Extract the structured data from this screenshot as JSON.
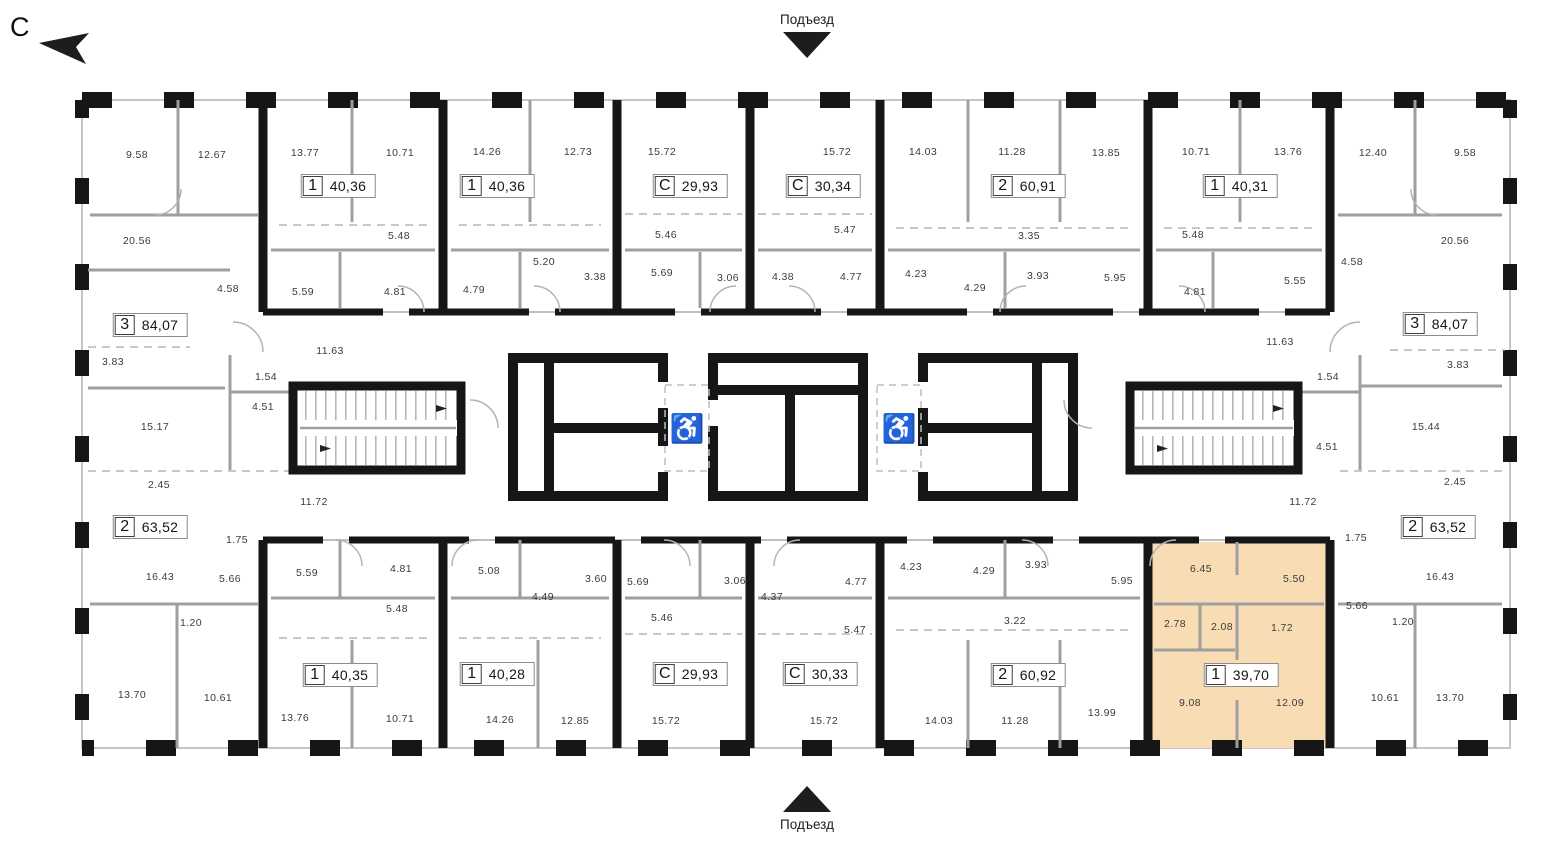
{
  "compass": {
    "label": "С"
  },
  "entrances": {
    "top_label": "Подъезд",
    "bottom_label": "Подъезд"
  },
  "icons": {
    "wheelchair": "♿",
    "compass_arrow": "compass-arrow",
    "entrance_arrow": "triangle"
  },
  "colors": {
    "highlight": "#F8DCB4",
    "wall": "#161616",
    "interior_wall": "#9f9f9f",
    "label_text": "#3b3b3b"
  },
  "plan": {
    "selected_apartment": {
      "rooms": "1",
      "area": "39,70",
      "rect": {
        "x": 1148,
        "y": 542,
        "w": 182,
        "h": 206
      }
    },
    "apartments": [
      {
        "rooms": "1",
        "area": "40,36",
        "x": 338,
        "y": 186
      },
      {
        "rooms": "1",
        "area": "40,36",
        "x": 497,
        "y": 186
      },
      {
        "rooms": "С",
        "area": "29,93",
        "x": 690,
        "y": 186
      },
      {
        "rooms": "С",
        "area": "30,34",
        "x": 823,
        "y": 186
      },
      {
        "rooms": "2",
        "area": "60,91",
        "x": 1028,
        "y": 186
      },
      {
        "rooms": "1",
        "area": "40,31",
        "x": 1240,
        "y": 186
      },
      {
        "rooms": "3",
        "area": "84,07",
        "x": 150,
        "y": 325
      },
      {
        "rooms": "3",
        "area": "84,07",
        "x": 1440,
        "y": 324
      },
      {
        "rooms": "2",
        "area": "63,52",
        "x": 150,
        "y": 527
      },
      {
        "rooms": "2",
        "area": "63,52",
        "x": 1438,
        "y": 527
      },
      {
        "rooms": "1",
        "area": "40,35",
        "x": 340,
        "y": 675
      },
      {
        "rooms": "1",
        "area": "40,28",
        "x": 497,
        "y": 674
      },
      {
        "rooms": "С",
        "area": "29,93",
        "x": 690,
        "y": 674
      },
      {
        "rooms": "С",
        "area": "30,33",
        "x": 820,
        "y": 674
      },
      {
        "rooms": "2",
        "area": "60,92",
        "x": 1028,
        "y": 675
      },
      {
        "rooms": "1",
        "area": "39,70",
        "x": 1241,
        "y": 675,
        "highlighted": true
      }
    ],
    "room_labels": [
      {
        "t": "9.58",
        "x": 137,
        "y": 155
      },
      {
        "t": "12.67",
        "x": 212,
        "y": 155
      },
      {
        "t": "13.77",
        "x": 305,
        "y": 153
      },
      {
        "t": "10.71",
        "x": 400,
        "y": 153
      },
      {
        "t": "14.26",
        "x": 487,
        "y": 152
      },
      {
        "t": "12.73",
        "x": 578,
        "y": 152
      },
      {
        "t": "15.72",
        "x": 662,
        "y": 152
      },
      {
        "t": "15.72",
        "x": 837,
        "y": 152
      },
      {
        "t": "14.03",
        "x": 923,
        "y": 152
      },
      {
        "t": "11.28",
        "x": 1012,
        "y": 152
      },
      {
        "t": "13.85",
        "x": 1106,
        "y": 153
      },
      {
        "t": "10.71",
        "x": 1196,
        "y": 152
      },
      {
        "t": "13.76",
        "x": 1288,
        "y": 152
      },
      {
        "t": "12.40",
        "x": 1373,
        "y": 153
      },
      {
        "t": "9.58",
        "x": 1465,
        "y": 153
      },
      {
        "t": "20.56",
        "x": 137,
        "y": 241
      },
      {
        "t": "5.48",
        "x": 399,
        "y": 236
      },
      {
        "t": "5.20",
        "x": 544,
        "y": 262
      },
      {
        "t": "5.46",
        "x": 666,
        "y": 235
      },
      {
        "t": "5.47",
        "x": 845,
        "y": 230
      },
      {
        "t": "3.35",
        "x": 1029,
        "y": 236
      },
      {
        "t": "5.48",
        "x": 1193,
        "y": 235
      },
      {
        "t": "4.58",
        "x": 1352,
        "y": 262
      },
      {
        "t": "20.56",
        "x": 1455,
        "y": 241
      },
      {
        "t": "4.58",
        "x": 228,
        "y": 289
      },
      {
        "t": "5.59",
        "x": 303,
        "y": 292
      },
      {
        "t": "4.81",
        "x": 395,
        "y": 292
      },
      {
        "t": "4.79",
        "x": 474,
        "y": 290
      },
      {
        "t": "3.38",
        "x": 595,
        "y": 277
      },
      {
        "t": "5.69",
        "x": 662,
        "y": 273
      },
      {
        "t": "3.06",
        "x": 728,
        "y": 278
      },
      {
        "t": "4.38",
        "x": 783,
        "y": 277
      },
      {
        "t": "4.77",
        "x": 851,
        "y": 277
      },
      {
        "t": "4.23",
        "x": 916,
        "y": 274
      },
      {
        "t": "4.29",
        "x": 975,
        "y": 288
      },
      {
        "t": "3.93",
        "x": 1038,
        "y": 276
      },
      {
        "t": "5.95",
        "x": 1115,
        "y": 278
      },
      {
        "t": "4.81",
        "x": 1195,
        "y": 292
      },
      {
        "t": "5.55",
        "x": 1295,
        "y": 281
      },
      {
        "t": "3.83",
        "x": 113,
        "y": 362
      },
      {
        "t": "11.63",
        "x": 330,
        "y": 351
      },
      {
        "t": "1.54",
        "x": 266,
        "y": 377
      },
      {
        "t": "4.51",
        "x": 263,
        "y": 407
      },
      {
        "t": "15.17",
        "x": 155,
        "y": 427
      },
      {
        "t": "2.45",
        "x": 159,
        "y": 485
      },
      {
        "t": "11.72",
        "x": 314,
        "y": 502
      },
      {
        "t": "11.63",
        "x": 1280,
        "y": 342
      },
      {
        "t": "1.54",
        "x": 1328,
        "y": 377
      },
      {
        "t": "3.83",
        "x": 1458,
        "y": 365
      },
      {
        "t": "4.51",
        "x": 1327,
        "y": 447
      },
      {
        "t": "15.44",
        "x": 1426,
        "y": 427
      },
      {
        "t": "2.45",
        "x": 1455,
        "y": 482
      },
      {
        "t": "11.72",
        "x": 1303,
        "y": 502
      },
      {
        "t": "1.75",
        "x": 237,
        "y": 540
      },
      {
        "t": "16.43",
        "x": 160,
        "y": 577
      },
      {
        "t": "5.66",
        "x": 230,
        "y": 579
      },
      {
        "t": "1.20",
        "x": 191,
        "y": 623
      },
      {
        "t": "13.70",
        "x": 132,
        "y": 695
      },
      {
        "t": "10.61",
        "x": 218,
        "y": 698
      },
      {
        "t": "5.59",
        "x": 307,
        "y": 573
      },
      {
        "t": "4.81",
        "x": 401,
        "y": 569
      },
      {
        "t": "5.48",
        "x": 397,
        "y": 609
      },
      {
        "t": "13.76",
        "x": 295,
        "y": 718
      },
      {
        "t": "10.71",
        "x": 400,
        "y": 719
      },
      {
        "t": "5.08",
        "x": 489,
        "y": 571
      },
      {
        "t": "3.60",
        "x": 596,
        "y": 579
      },
      {
        "t": "4.49",
        "x": 543,
        "y": 597
      },
      {
        "t": "14.26",
        "x": 500,
        "y": 720
      },
      {
        "t": "12.85",
        "x": 575,
        "y": 721
      },
      {
        "t": "5.69",
        "x": 638,
        "y": 582
      },
      {
        "t": "3.06",
        "x": 735,
        "y": 581
      },
      {
        "t": "5.46",
        "x": 662,
        "y": 618
      },
      {
        "t": "15.72",
        "x": 666,
        "y": 721
      },
      {
        "t": "4.37",
        "x": 772,
        "y": 597
      },
      {
        "t": "4.77",
        "x": 856,
        "y": 582
      },
      {
        "t": "5.47",
        "x": 855,
        "y": 630
      },
      {
        "t": "15.72",
        "x": 824,
        "y": 721
      },
      {
        "t": "4.23",
        "x": 911,
        "y": 567
      },
      {
        "t": "4.29",
        "x": 984,
        "y": 571
      },
      {
        "t": "3.93",
        "x": 1036,
        "y": 565
      },
      {
        "t": "5.95",
        "x": 1122,
        "y": 581
      },
      {
        "t": "3.22",
        "x": 1015,
        "y": 621
      },
      {
        "t": "14.03",
        "x": 939,
        "y": 721
      },
      {
        "t": "11.28",
        "x": 1015,
        "y": 721
      },
      {
        "t": "13.99",
        "x": 1102,
        "y": 713
      },
      {
        "t": "6.45",
        "x": 1201,
        "y": 569
      },
      {
        "t": "5.50",
        "x": 1294,
        "y": 579
      },
      {
        "t": "2.78",
        "x": 1175,
        "y": 624
      },
      {
        "t": "2.08",
        "x": 1222,
        "y": 627
      },
      {
        "t": "1.72",
        "x": 1282,
        "y": 628
      },
      {
        "t": "9.08",
        "x": 1190,
        "y": 703
      },
      {
        "t": "12.09",
        "x": 1290,
        "y": 703
      },
      {
        "t": "1.75",
        "x": 1356,
        "y": 538
      },
      {
        "t": "16.43",
        "x": 1440,
        "y": 577
      },
      {
        "t": "5.66",
        "x": 1357,
        "y": 606
      },
      {
        "t": "1.20",
        "x": 1403,
        "y": 622
      },
      {
        "t": "10.61",
        "x": 1385,
        "y": 698
      },
      {
        "t": "13.70",
        "x": 1450,
        "y": 698
      }
    ]
  }
}
